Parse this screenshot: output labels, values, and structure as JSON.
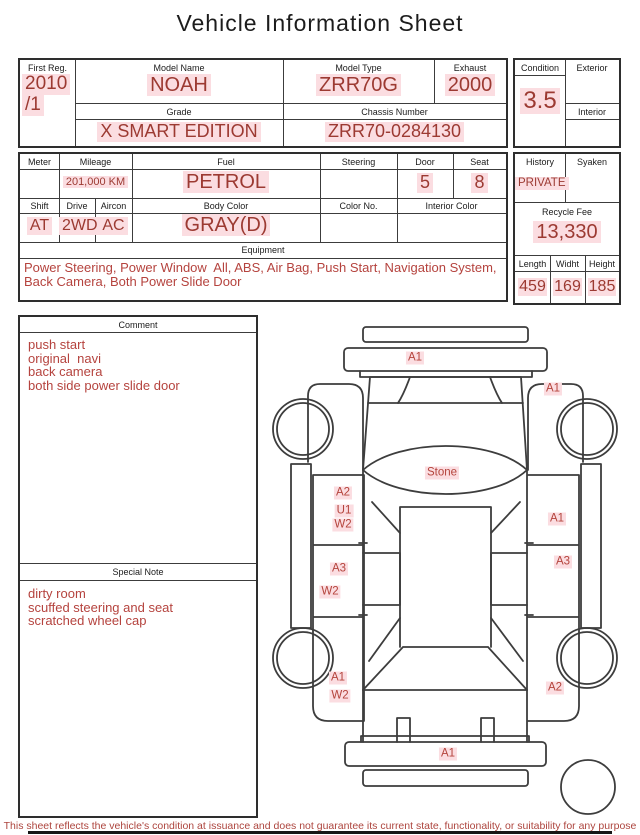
{
  "title": "Vehicle Information Sheet",
  "colors": {
    "value_red": "#9c3a32",
    "note_red": "#b5433e",
    "highlight_pink": "#fbdde1",
    "line_dark": "#3c3c3c"
  },
  "vehicle": {
    "first_reg": {
      "label": "First Reg.",
      "line1": "2010",
      "line2": "/1"
    },
    "model_name": {
      "label": "Model Name",
      "value": "NOAH"
    },
    "model_type": {
      "label": "Model Type",
      "value": "ZRR70G"
    },
    "exhaust": {
      "label": "Exhaust",
      "value": "2000"
    },
    "grade": {
      "label": "Grade",
      "value": "X SMART EDITION"
    },
    "chassis_number": {
      "label": "Chassis Number",
      "value": "ZRR70-0284130"
    },
    "condition": {
      "label": "Condition",
      "value": "3.5"
    },
    "exterior": {
      "label": "Exterior",
      "value": ""
    },
    "interior": {
      "label": "Interior",
      "value": ""
    }
  },
  "details": {
    "meter": {
      "label": "Meter",
      "value": ""
    },
    "mileage": {
      "label": "Mileage",
      "value": "201,000 KM"
    },
    "fuel": {
      "label": "Fuel",
      "value": "PETROL"
    },
    "steering": {
      "label": "Steering",
      "value": ""
    },
    "door": {
      "label": "Door",
      "value": "5"
    },
    "seat": {
      "label": "Seat",
      "value": "8"
    },
    "shift": {
      "label": "Shift",
      "value": "AT"
    },
    "drive": {
      "label": "Drive",
      "value": "2WD"
    },
    "aircon": {
      "label": "Aircon",
      "value": "AC"
    },
    "body_color": {
      "label": "Body Color",
      "value": "GRAY(D)"
    },
    "color_no": {
      "label": "Color No.",
      "value": ""
    },
    "interior_color": {
      "label": "Interior Color",
      "value": ""
    },
    "equipment": {
      "label": "Equipment",
      "value": "Power Steering, Power Window  All, ABS, Air Bag, Push Start, Navigation System, Back Camera, Both Power Slide Door"
    },
    "history": {
      "label": "History",
      "value": "PRIVATE"
    },
    "syaken": {
      "label": "Syaken",
      "value": ""
    },
    "recycle_fee": {
      "label": "Recycle Fee",
      "value": "13,330"
    },
    "length": {
      "label": "Length",
      "value": "459"
    },
    "width": {
      "label": "Widht",
      "value": "169"
    },
    "height": {
      "label": "Height",
      "value": "185"
    }
  },
  "comment": {
    "header": "Comment",
    "lines": [
      "push start",
      "original  navi",
      "back camera",
      "both side power slide door"
    ]
  },
  "special_note": {
    "header": "Special Note",
    "lines": [
      "dirty room",
      "scuffed steering and seat",
      "scratched wheel cap"
    ]
  },
  "diagram": {
    "markers": [
      {
        "text": "A1",
        "x": 150,
        "y": 40,
        "area": "front-bumper"
      },
      {
        "text": "A1",
        "x": 288,
        "y": 71,
        "area": "right-front-fender"
      },
      {
        "text": "Stone",
        "x": 177,
        "y": 155,
        "area": "windshield"
      },
      {
        "text": "A2",
        "x": 78,
        "y": 175,
        "area": "left-front-door"
      },
      {
        "text": "U1",
        "x": 79,
        "y": 193,
        "area": "left-front-door"
      },
      {
        "text": "W2",
        "x": 78,
        "y": 207,
        "area": "left-front-door"
      },
      {
        "text": "A1",
        "x": 292,
        "y": 201,
        "area": "right-front-door"
      },
      {
        "text": "A3",
        "x": 74,
        "y": 251,
        "area": "left-slide-door"
      },
      {
        "text": "A3",
        "x": 298,
        "y": 244,
        "area": "right-slide-door"
      },
      {
        "text": "W2",
        "x": 65,
        "y": 274,
        "area": "left-slide-door"
      },
      {
        "text": "A1",
        "x": 73,
        "y": 360,
        "area": "left-rear-fender"
      },
      {
        "text": "W2",
        "x": 75,
        "y": 378,
        "area": "left-rear-fender"
      },
      {
        "text": "A2",
        "x": 290,
        "y": 370,
        "area": "right-rear-fender"
      },
      {
        "text": "A1",
        "x": 183,
        "y": 436,
        "area": "rear-bumper"
      }
    ]
  },
  "disclaimer": "This sheet reflects the vehicle's condition at issuance and does not guarantee its current state, functionality, or suitability for any purpose"
}
